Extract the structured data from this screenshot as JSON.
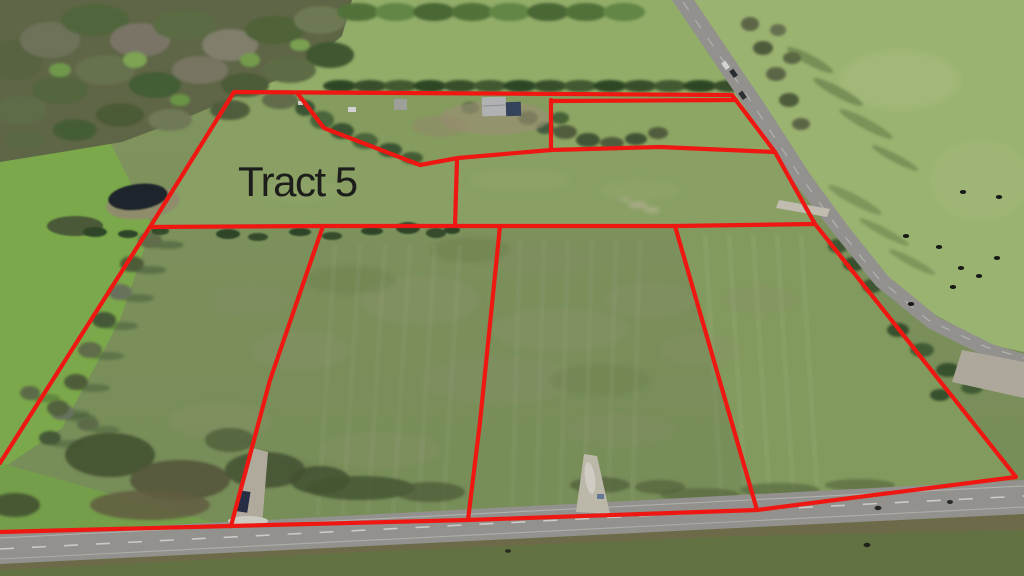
{
  "overlay": {
    "tract_label": {
      "text": "Tract 5"
    },
    "label_color": "#1d1d1b",
    "line_color": "#ee1712",
    "line_width": 4.2,
    "boundaries": {
      "perimeter": [
        [
          0,
          532
        ],
        [
          230,
          526
        ],
        [
          468,
          520
        ],
        [
          757,
          510
        ],
        [
          1016,
          477
        ],
        [
          955,
          400
        ],
        [
          815,
          224
        ],
        [
          775,
          152
        ],
        [
          732,
          95
        ],
        [
          234,
          92
        ],
        [
          150,
          227
        ],
        [
          0,
          463
        ]
      ],
      "mid_line": [
        [
          150,
          227
        ],
        [
          323,
          226
        ],
        [
          455,
          226
        ],
        [
          500,
          226
        ],
        [
          675,
          226
        ],
        [
          815,
          224
        ]
      ],
      "division_west": [
        [
          323,
          226
        ],
        [
          270,
          380
        ],
        [
          231,
          526
        ]
      ],
      "division_center": [
        [
          500,
          226
        ],
        [
          480,
          422
        ],
        [
          468,
          520
        ]
      ],
      "division_east": [
        [
          675,
          226
        ],
        [
          731,
          420
        ],
        [
          757,
          510
        ]
      ],
      "homestead_cutline": [
        [
          298,
          94
        ],
        [
          324,
          128
        ],
        [
          420,
          165
        ],
        [
          458,
          158
        ],
        [
          551,
          150
        ]
      ],
      "north_tract_west": [
        [
          551,
          100
        ],
        [
          551,
          150
        ]
      ],
      "north_tract_top": [
        [
          551,
          101
        ],
        [
          736,
          100
        ]
      ],
      "north_tract_south": [
        [
          551,
          150
        ],
        [
          660,
          147
        ],
        [
          775,
          152
        ]
      ],
      "cutline_connector": [
        [
          457,
          159
        ],
        [
          455,
          226
        ]
      ]
    }
  }
}
